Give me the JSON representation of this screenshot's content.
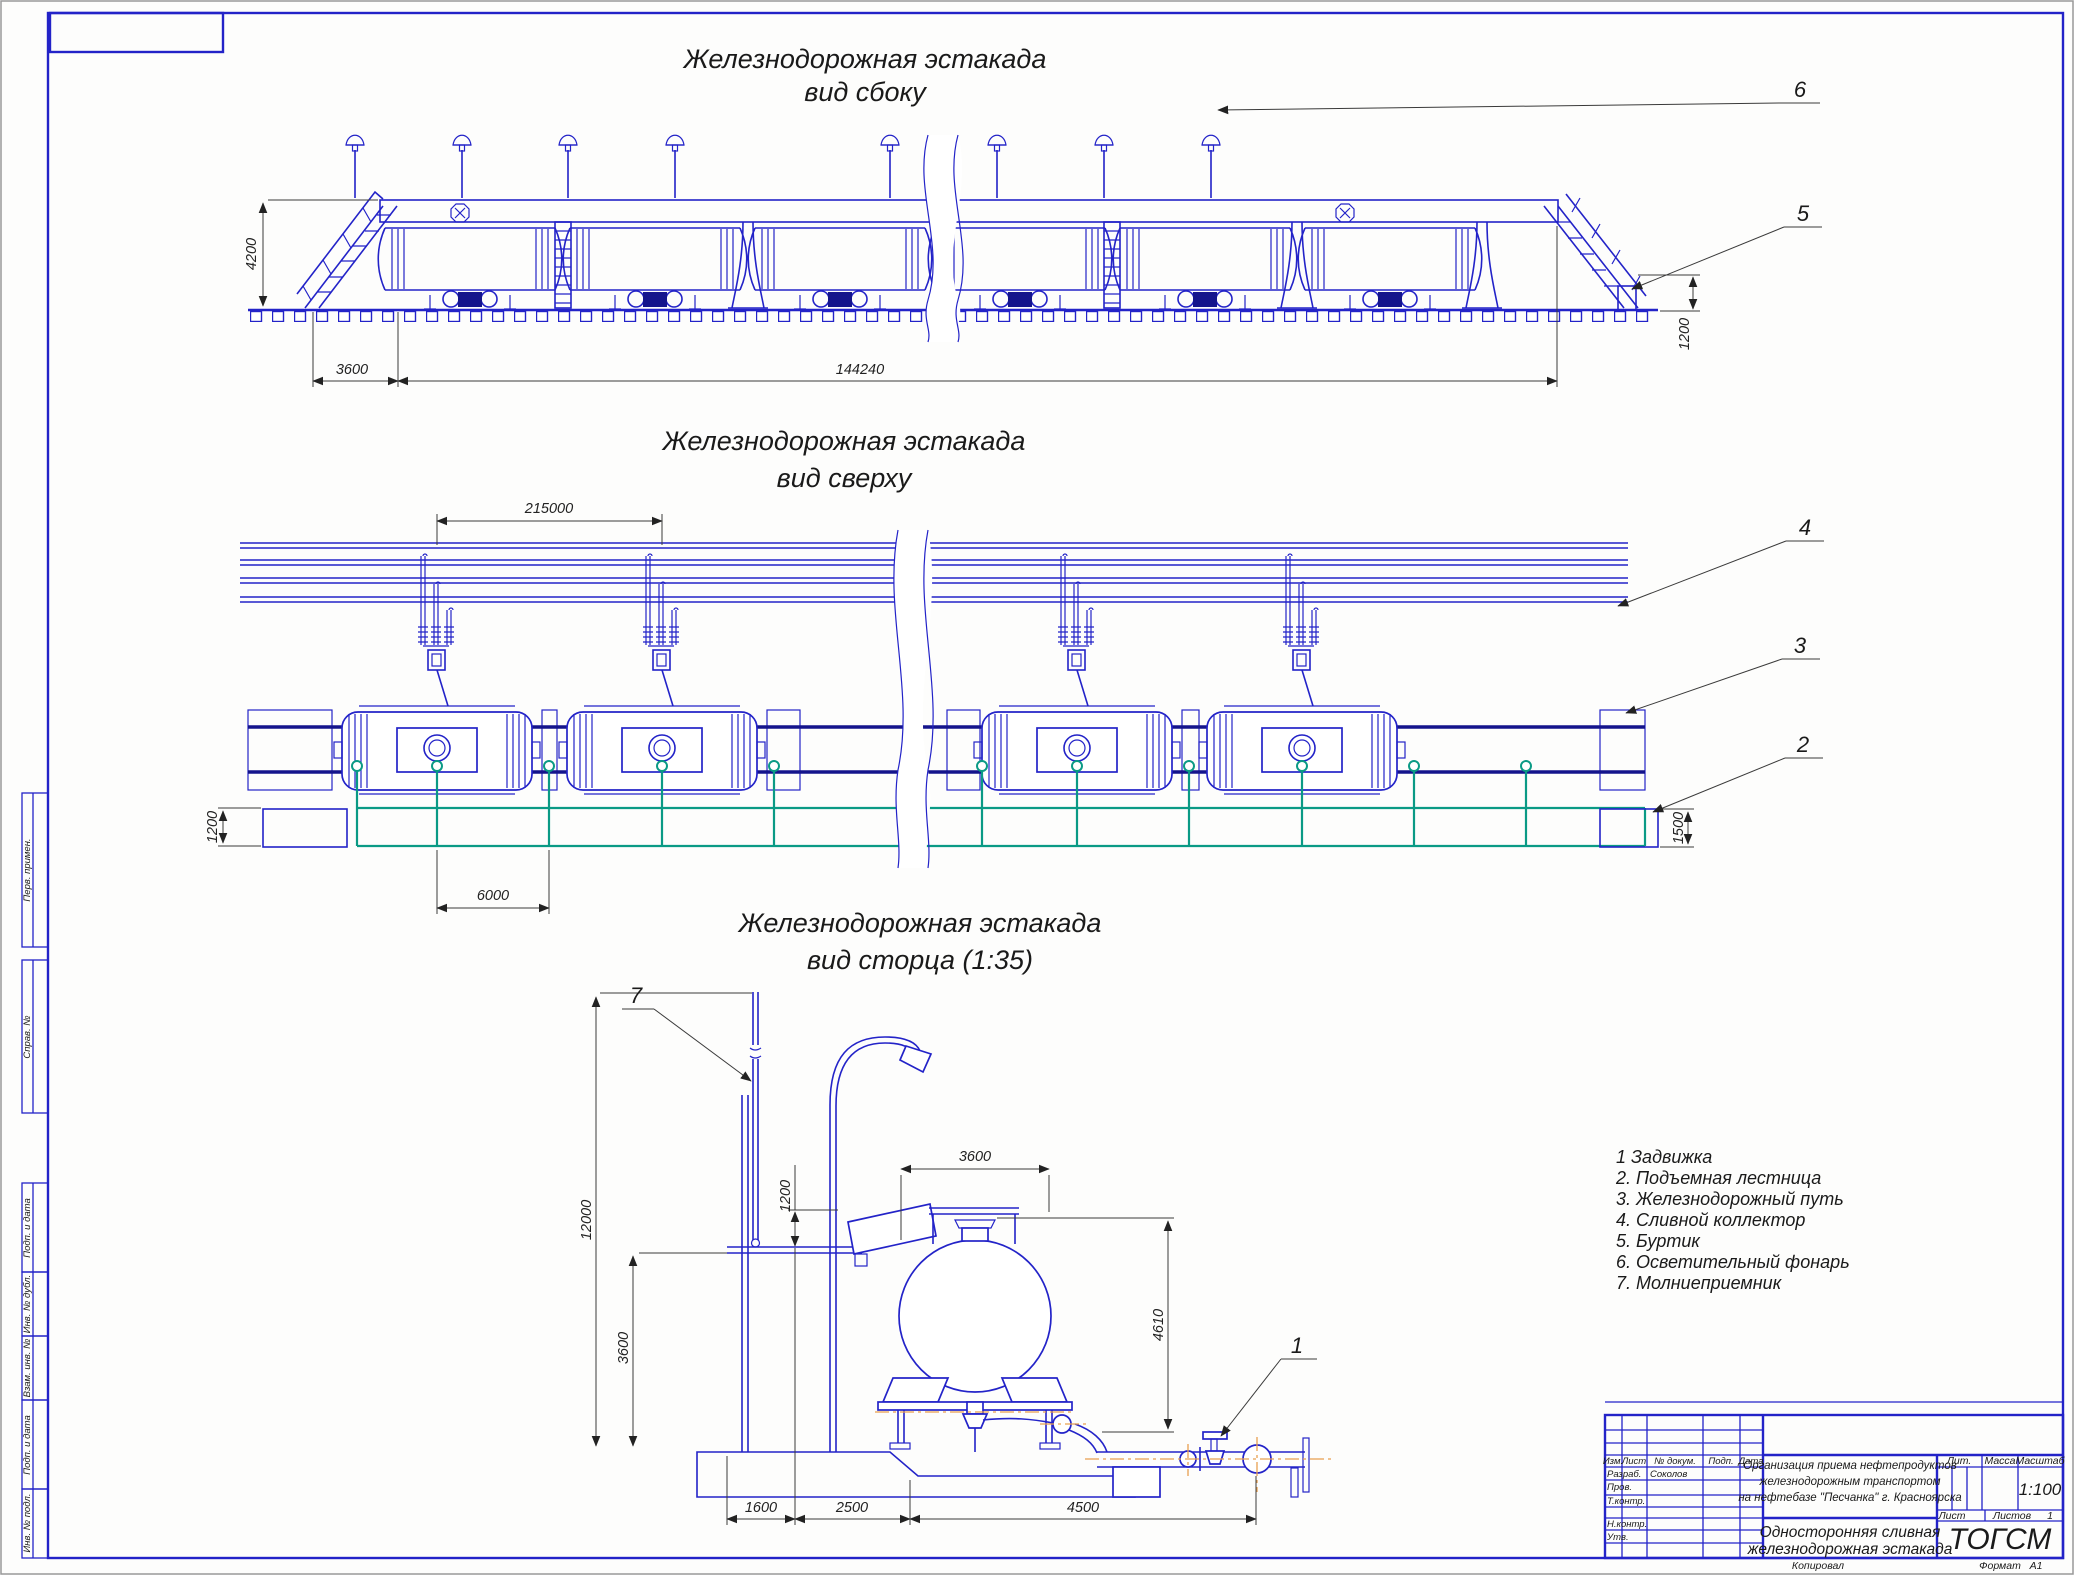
{
  "titles": {
    "side": [
      "Железнодорожная эстакада",
      "вид сбоку"
    ],
    "plan": [
      "Железнодорожная эстакада",
      "вид сверху"
    ],
    "end": [
      "Железнодорожная эстакада",
      "вид сторца (1:35)"
    ]
  },
  "dims": {
    "side_height": "4200",
    "side_ramp": "3600",
    "side_length": "144240",
    "side_curb": "1200",
    "plan_span": "215000",
    "plan_ladder_w": "1200",
    "plan_drain": "6000",
    "plan_ladder_r": "1500",
    "end_mast": "12000",
    "end_deck": "3600",
    "end_gap": "1200",
    "end_tank": "3600",
    "end_drain": "4610",
    "end_b1": "1600",
    "end_b2": "2500",
    "end_b3": "4500"
  },
  "callouts": {
    "n1": "1",
    "n2": "2",
    "n3": "3",
    "n4": "4",
    "n5": "5",
    "n6": "6",
    "n7": "7"
  },
  "legend": [
    "1 Задвижка",
    "2. Подъемная лестница",
    "3. Железнодорожный путь",
    "4. Сливной коллектор",
    "5. Буртик",
    "6. Осветительный фонарь",
    "7. Молниеприемник"
  ],
  "margin": [
    "Перв. примен.",
    "Справ. №",
    "Подп. и дата",
    "Инв. № дубл.",
    "Взам. инв. №",
    "Подп. и дата",
    "Инв. № подл."
  ],
  "title_block": {
    "col_izm": "Изм.",
    "col_list": "Лист",
    "col_doc": "№ докум.",
    "col_podp": "Подп.",
    "col_data": "Дата",
    "row_razrab": "Разраб.",
    "razrab_name": "Соколов",
    "row_prov": "Пров.",
    "row_tkontr": "Т.контр.",
    "row_nkontr": "Н.контр.",
    "row_utv": "Утв.",
    "project": [
      "Организация приема нефтепродуктов",
      "железнодорожным транспортом",
      "на нефтебазе \"Песчанка\" г. Красноярска"
    ],
    "lit": "Лит.",
    "massa": "Масса",
    "masshtab": "Масштаб",
    "scale": "1:100",
    "list_label": "Лист",
    "listov_label": "Листов",
    "listov_value": "1",
    "doc_title": [
      "Односторонняя сливная",
      "железнодорожная эстакада"
    ],
    "org": "ТОГСМ"
  },
  "footer": {
    "kopiroval": "Копировал",
    "format_label": "Формат",
    "format_value": "А1"
  },
  "colors": {
    "drawing": "#2323c8",
    "rail": "#14148c",
    "collector": "#0a9a85",
    "centerline": "#e8a050",
    "dimension": "#3a3a3a",
    "text": "#1a1a1a",
    "sheet": "#ffffff"
  }
}
